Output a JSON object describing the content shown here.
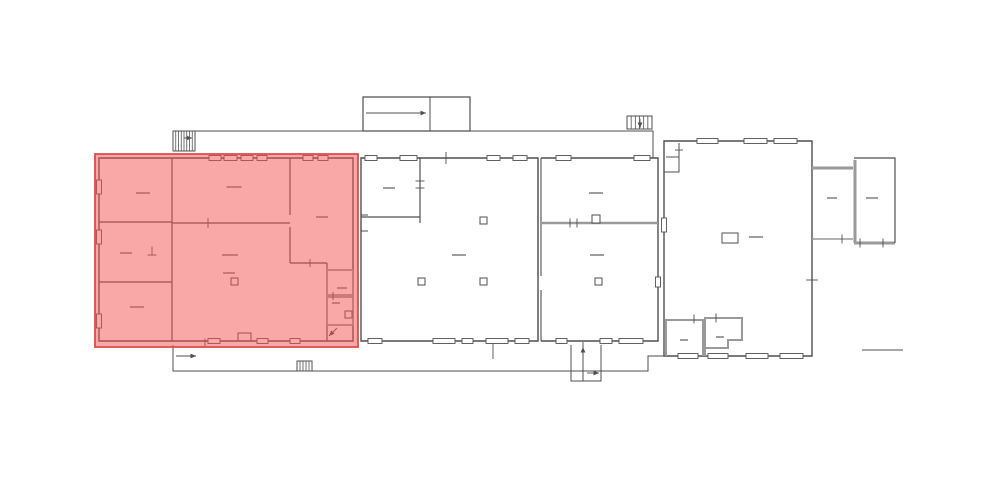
{
  "canvas": {
    "width": 1000,
    "height": 477,
    "background": "#ffffff"
  },
  "colors": {
    "wall": "#4f4f4f",
    "light": "#9a9a9a",
    "label": "#6a6a6a",
    "window_fill": "#ffffff",
    "highlight_fill": "rgba(243,82,80,0.5)",
    "highlight_stroke": "#e04a46"
  },
  "highlight": {
    "name": "selected-wing-overlay",
    "points": "95,154 358,154 358,347 95,347"
  },
  "floorplan": {
    "segments": [
      {
        "n": "left-wing-outline",
        "d": "M99,158 H353 V341 H99 Z",
        "w": 1.4,
        "c": "wall"
      },
      {
        "n": "left-wing-partition-main",
        "d": "M172,158 V341",
        "w": 1.2,
        "c": "wall"
      },
      {
        "n": "left-wing-partition-h1",
        "d": "M99,222 H172",
        "w": 1.2,
        "c": "wall"
      },
      {
        "n": "left-wing-partition-h2",
        "d": "M99,282 H172",
        "w": 1.2,
        "c": "wall"
      },
      {
        "n": "left-wing-partition-h3",
        "d": "M172,223 H290",
        "w": 1.2,
        "c": "wall"
      },
      {
        "n": "left-wing-partition-v2",
        "d": "M290,158 V215 M290,227 V263",
        "w": 1.2,
        "c": "wall"
      },
      {
        "n": "left-wing-partition-h4",
        "d": "M290,263 H327",
        "w": 1.2,
        "c": "wall"
      },
      {
        "n": "left-wing-partition-v3",
        "d": "M327,263 V341",
        "w": 1.2,
        "c": "wall"
      },
      {
        "n": "left-wing-niche",
        "d": "M238,341 V333 H251 V341",
        "w": 1,
        "c": "wall"
      },
      {
        "n": "hall-a-outline",
        "d": "M361,158 H538 V341 H361 Z",
        "w": 1.4,
        "c": "wall"
      },
      {
        "n": "hall-a-room",
        "d": "M361,217 H420 M420,158 V223",
        "w": 1.2,
        "c": "wall"
      },
      {
        "n": "hall-a-wall-brackets",
        "d": "M361,215 h7 M361,231 h7",
        "w": 1,
        "c": "wall"
      },
      {
        "n": "divider-wall",
        "d": "M538,158 V276 M538,290 V341 M541,158 V276 M541,290 V341",
        "w": 1.1,
        "c": "wall"
      },
      {
        "n": "hall-b-outline",
        "d": "M541,158 H658 V341 H541",
        "w": 1.4,
        "c": "wall"
      },
      {
        "n": "hall-b-gray-wall",
        "d": "M541,223 H658",
        "w": 2.6,
        "c": "light"
      },
      {
        "n": "right-wing-outline",
        "d": "M664,141 H812 V356 H664 Z",
        "w": 1.4,
        "c": "wall"
      },
      {
        "n": "right-wing-vestibule",
        "d": "M679,143 V172 H664 M666,157 H679",
        "w": 1,
        "c": "wall"
      },
      {
        "n": "right-wing-room1",
        "d": "M666,356 V320 H703 V356",
        "w": 2,
        "c": "light"
      },
      {
        "n": "right-wing-room2",
        "d": "M705,356 V318 H742 V340 H728 V348 H705 V356",
        "w": 2,
        "c": "light"
      },
      {
        "n": "annex-corridor-top",
        "d": "M812,168 H853",
        "w": 3,
        "c": "light"
      },
      {
        "n": "annex-corridor-bottom",
        "d": "M812,239 H853",
        "w": 1.6,
        "c": "light"
      },
      {
        "n": "annex-wall-left",
        "d": "M855,160 V243",
        "w": 3,
        "c": "light"
      },
      {
        "n": "annex-wall-bottom",
        "d": "M854,243 H895",
        "w": 3,
        "c": "light"
      },
      {
        "n": "annex-outline",
        "d": "M854,158 H895 V243",
        "w": 1.2,
        "c": "wall"
      },
      {
        "n": "rear-platform-edge",
        "d": "M195,131 H653 V158",
        "w": 1,
        "c": "wall"
      },
      {
        "n": "ramp-outline",
        "d": "M363,97 H470 V131 H363 Z",
        "w": 1.2,
        "c": "wall"
      },
      {
        "n": "ramp-divider",
        "d": "M430,97 V131",
        "w": 1,
        "c": "wall"
      },
      {
        "n": "front-platform-edge",
        "d": "M173,345 V371 H648 V356 H664",
        "w": 1,
        "c": "wall"
      },
      {
        "n": "entry-porch",
        "d": "M571,345 V381 H601 V345 M583,345 V381",
        "w": 1,
        "c": "wall"
      },
      {
        "n": "dim-line-right",
        "d": "M862,350 H903",
        "w": 1,
        "c": "wall"
      }
    ],
    "rects": [
      {
        "n": "wc-room-1",
        "x": 327,
        "y": 270,
        "w": 26,
        "h": 25,
        "sw": 1.8,
        "c": "light"
      },
      {
        "n": "wc-room-2",
        "x": 327,
        "y": 297,
        "w": 26,
        "h": 28,
        "sw": 1.8,
        "c": "light"
      },
      {
        "n": "wc-fixture",
        "x": 345,
        "y": 311,
        "w": 7,
        "h": 7,
        "sw": 1,
        "c": "wall"
      },
      {
        "n": "hall-b-door-notch",
        "x": 592,
        "y": 215,
        "w": 8,
        "h": 8,
        "sw": 1,
        "c": "wall"
      },
      {
        "n": "right-wing-table",
        "x": 722,
        "y": 233,
        "w": 16,
        "h": 10,
        "sw": 1,
        "c": "wall"
      }
    ],
    "pillars": [
      {
        "n": "pillar",
        "x": 231,
        "y": 278,
        "s": 7
      },
      {
        "n": "pillar",
        "x": 480,
        "y": 217,
        "s": 7
      },
      {
        "n": "pillar",
        "x": 418,
        "y": 278,
        "s": 7
      },
      {
        "n": "pillar",
        "x": 480,
        "y": 278,
        "s": 7
      },
      {
        "n": "pillar",
        "x": 595,
        "y": 278,
        "s": 7
      }
    ],
    "windows": [
      [
        209,
        158,
        12,
        "h"
      ],
      [
        224,
        158,
        13,
        "h"
      ],
      [
        241,
        158,
        12,
        "h"
      ],
      [
        257,
        158,
        10,
        "h"
      ],
      [
        303,
        158,
        10,
        "h"
      ],
      [
        318,
        158,
        10,
        "h"
      ],
      [
        99,
        180,
        14,
        "v"
      ],
      [
        99,
        230,
        14,
        "v"
      ],
      [
        99,
        314,
        14,
        "v"
      ],
      [
        208,
        341,
        12,
        "h"
      ],
      [
        257,
        341,
        11,
        "h"
      ],
      [
        290,
        341,
        10,
        "h"
      ],
      [
        365,
        158,
        12,
        "h"
      ],
      [
        400,
        158,
        17,
        "h"
      ],
      [
        487,
        158,
        13,
        "h"
      ],
      [
        513,
        158,
        14,
        "h"
      ],
      [
        368,
        341,
        14,
        "h"
      ],
      [
        433,
        341,
        22,
        "h"
      ],
      [
        462,
        341,
        11,
        "h"
      ],
      [
        486,
        341,
        22,
        "h"
      ],
      [
        515,
        341,
        14,
        "h"
      ],
      [
        556,
        158,
        15,
        "h"
      ],
      [
        634,
        158,
        16,
        "h"
      ],
      [
        556,
        341,
        11,
        "h"
      ],
      [
        600,
        341,
        12,
        "h"
      ],
      [
        619,
        341,
        24,
        "h"
      ],
      [
        658,
        277,
        10,
        "v"
      ],
      [
        697,
        141,
        21,
        "h"
      ],
      [
        744,
        141,
        23,
        "h"
      ],
      [
        774,
        141,
        23,
        "h"
      ],
      [
        678,
        356,
        20,
        "h"
      ],
      [
        708,
        356,
        20,
        "h"
      ],
      [
        746,
        356,
        22,
        "h"
      ],
      [
        780,
        356,
        23,
        "h"
      ],
      [
        664,
        218,
        14,
        "v"
      ]
    ],
    "labels": [
      [
        143,
        193,
        14
      ],
      [
        126,
        253,
        12
      ],
      [
        137,
        307,
        14
      ],
      [
        234,
        187,
        15
      ],
      [
        322,
        217,
        12
      ],
      [
        230,
        255,
        16
      ],
      [
        229,
        273,
        12
      ],
      [
        342,
        288,
        10
      ],
      [
        336,
        303,
        8
      ],
      [
        389,
        188,
        12
      ],
      [
        459,
        255,
        14
      ],
      [
        596,
        193,
        14
      ],
      [
        597,
        255,
        14
      ],
      [
        756,
        237,
        14
      ],
      [
        684,
        340,
        8
      ],
      [
        720,
        337,
        8
      ],
      [
        832,
        198,
        10
      ],
      [
        872,
        198,
        12
      ]
    ],
    "ticks": [
      [
        208,
        223,
        "v",
        10
      ],
      [
        446,
        158,
        "v",
        12
      ],
      [
        570,
        223,
        "v",
        9
      ],
      [
        577,
        223,
        "v",
        9
      ],
      [
        694,
        319,
        "v",
        9
      ],
      [
        716,
        318,
        "v",
        9
      ],
      [
        812,
        280,
        "h",
        12
      ],
      [
        842,
        239,
        "v",
        9
      ],
      [
        860,
        243,
        "v",
        9
      ],
      [
        883,
        243,
        "v",
        9
      ],
      [
        205,
        343,
        "v",
        9
      ],
      [
        493,
        351,
        "v",
        16
      ],
      [
        333,
        296,
        "v",
        8
      ],
      [
        310,
        263,
        "v",
        8
      ],
      [
        420,
        181,
        "h",
        9
      ],
      [
        420,
        188,
        "h",
        9
      ],
      [
        679,
        150,
        "h",
        8
      ],
      [
        583,
        346,
        "v",
        8
      ],
      [
        152,
        251,
        "v",
        9
      ],
      [
        152,
        255,
        "h",
        9
      ]
    ],
    "arrows": [
      [
        366,
        113,
        426,
        113
      ],
      [
        176,
        356,
        196,
        356
      ],
      [
        587,
        373,
        599,
        373
      ],
      [
        583,
        357,
        583,
        347
      ],
      [
        640,
        119,
        640,
        128
      ],
      [
        184,
        138,
        192,
        138
      ],
      [
        337,
        328,
        329,
        336
      ]
    ],
    "stairs": [
      {
        "n": "stairs-rear-left",
        "x": 173,
        "y": 131,
        "w": 22,
        "h": 20,
        "steps": 7
      },
      {
        "n": "stairs-rear-right",
        "x": 627,
        "y": 116,
        "w": 25,
        "h": 13,
        "steps": 5
      },
      {
        "n": "stairs-front-small",
        "x": 297,
        "y": 361,
        "w": 15,
        "h": 10,
        "steps": 4
      }
    ]
  }
}
